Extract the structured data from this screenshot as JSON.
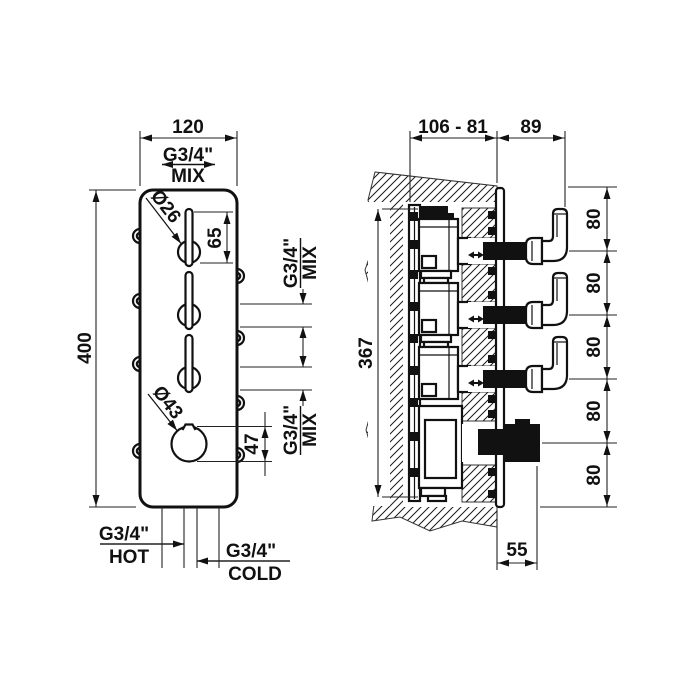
{
  "front_view": {
    "width_mm": "120",
    "height_mm": "400",
    "top_outlet": {
      "thread": "G3/4\"",
      "label": "MIX"
    },
    "lever_diameter": "Ø26",
    "lever_length": "65",
    "side_outlet_upper": {
      "thread": "G3/4\"",
      "label": "MIX"
    },
    "side_outlet_lower": {
      "thread": "G3/4\"",
      "label": "MIX"
    },
    "knob_diameter": "Ø43",
    "knob_height": "47",
    "inlet_hot": {
      "thread": "G3/4\"",
      "label": "HOT"
    },
    "inlet_cold": {
      "thread": "G3/4\"",
      "label": "COLD"
    }
  },
  "side_view": {
    "recess_depth_range": "106 - 81",
    "lever_projection": "89",
    "body_height": "367",
    "spacings": [
      "80",
      "80",
      "80",
      "80",
      "80"
    ],
    "knob_projection": "55"
  },
  "colors": {
    "line": "#111111",
    "background": "#ffffff"
  }
}
